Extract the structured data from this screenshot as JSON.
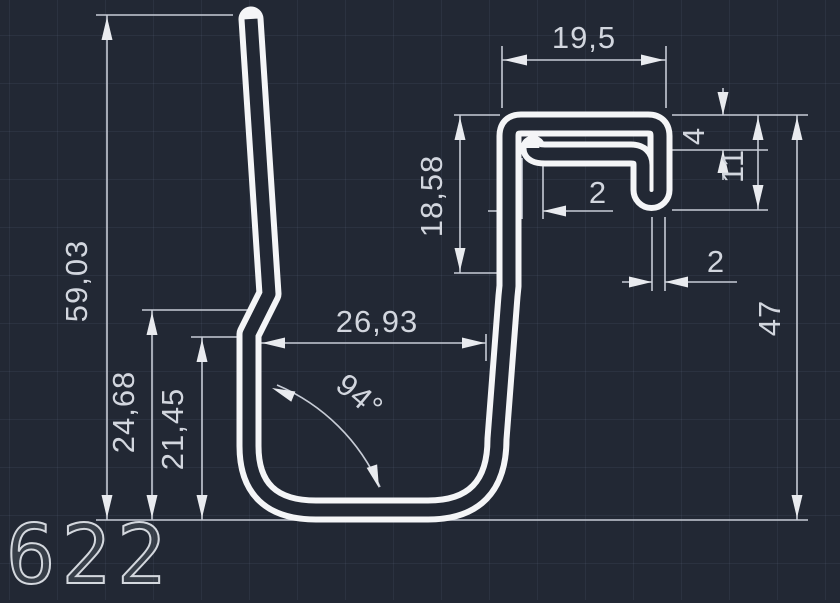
{
  "drawing": {
    "profile_number": "622",
    "colors": {
      "background": "#222834",
      "profile_line": "#f4f5f7",
      "dimension_line": "#c7ccd6",
      "dimension_text": "#d2d6de"
    },
    "dimensions": {
      "top_width": "19,5",
      "hook_opening": "4",
      "hook_depth": "11",
      "tab_thickness": "2",
      "wall_thickness": "2",
      "right_height": "47",
      "hook_side_height": "18,58",
      "base_width": "26,93",
      "bottom_angle": "94°",
      "left_height": "59,03",
      "jog_upper_height": "24,68",
      "jog_lower_height": "21,45"
    }
  }
}
